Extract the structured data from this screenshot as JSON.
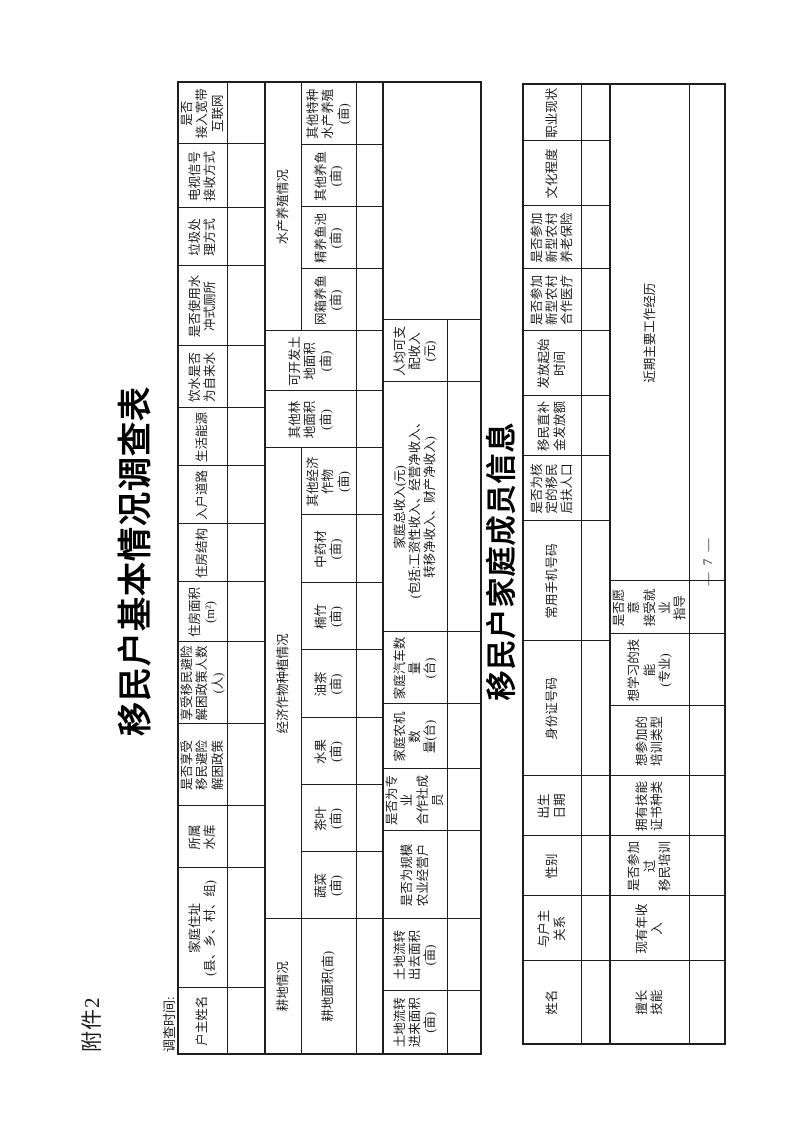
{
  "page": {
    "attachment_label": "附件2",
    "survey_time_label": "调查时间:",
    "page_number": "— 7 —"
  },
  "table1": {
    "title": "移民户基本情况调查表",
    "header_row": [
      "户主姓名",
      "家庭住址\n(县、乡、村、组)",
      "所属\n水库",
      "是否享受\n移民避险\n解困政策",
      "享受移民避险\n解困政策人数\n(人)",
      "住房面积\n(m²)",
      "住房结构",
      "入户道路",
      "生活能源",
      "饮水是否\n为自来水",
      "是否使用水\n冲式厕所",
      "垃圾处\n理方式",
      "电视信号\n接收方式",
      "是否\n接入宽带\n互联网"
    ],
    "sections": {
      "farmland": "耕地情况",
      "cash_crops": "经济作物种植情况",
      "other_forest": "其他林\n地面积\n(亩)",
      "developable": "可开发土\n地面积\n(亩)",
      "aquaculture": "水产养殖情况"
    },
    "planting_row": [
      "耕地面积(亩)",
      "蔬菜\n(亩)",
      "茶叶\n(亩)",
      "水果\n(亩)",
      "油茶\n(亩)",
      "楠竹\n(亩)",
      "中药材\n(亩)",
      "其他经济\n作物\n(亩)",
      "网箱养鱼\n(亩)",
      "精养鱼池\n(亩)",
      "其他养鱼\n(亩)",
      "其他特种\n水产养殖\n(亩)"
    ],
    "economy_row": [
      "土地流转\n进来面积\n(亩)",
      "土地流转\n出去面积\n(亩)",
      "是否为规模\n农业经营户",
      "是否为专业\n合作社成员",
      "家庭农机数\n量(台)",
      "家庭汽车数量\n(台)",
      "家庭总收入(元)\n(包括:工资性收入、经营净收入、\n转移净收入、财产净收入)",
      "人均可支\n配收入\n(元)"
    ]
  },
  "table2": {
    "title": "移民户家庭成员信息",
    "member_header_row": [
      "姓名",
      "与户主\n关系",
      "性别",
      "出生\n日期",
      "身份证号码",
      "常用手机号码",
      "是否为核\n定的移民\n后扶人口",
      "移民直补\n金发放额",
      "发放起始\n时间",
      "是否参加\n新型农村\n合作医疗",
      "是否参加\n新型农村\n养老保险",
      "文化程度",
      "职业现状"
    ],
    "skill_header_row": [
      "擅长\n技能",
      "现有年收入",
      "是否参加过\n移民培训",
      "拥有技能\n证书种类",
      "想参加的\n培训类型",
      "想学习的技能\n(专业)",
      "是否愿意\n接受就业\n指导",
      "近期主要工作经历"
    ]
  }
}
